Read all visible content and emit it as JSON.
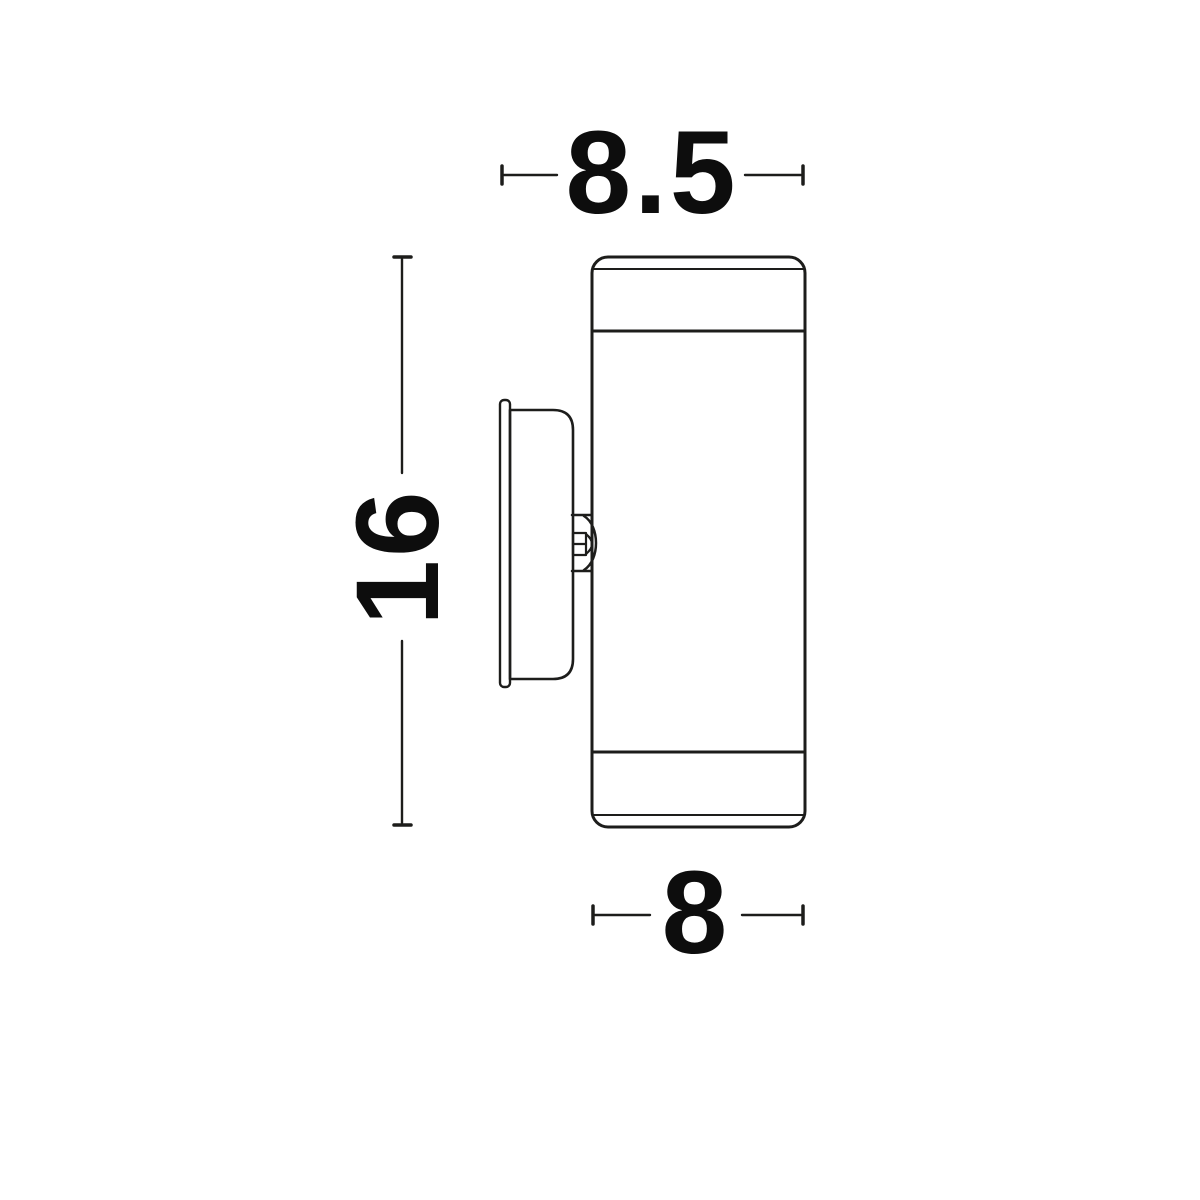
{
  "drawing": {
    "title": "Wall light fixture side-view dimension drawing",
    "line_color": "#1d1d1b",
    "text_color": "#0d0d0d",
    "background_color": "#ffffff",
    "dimensions": {
      "top_depth_label": "8.5",
      "height_label": "16",
      "bottom_diameter_label": "8"
    }
  }
}
